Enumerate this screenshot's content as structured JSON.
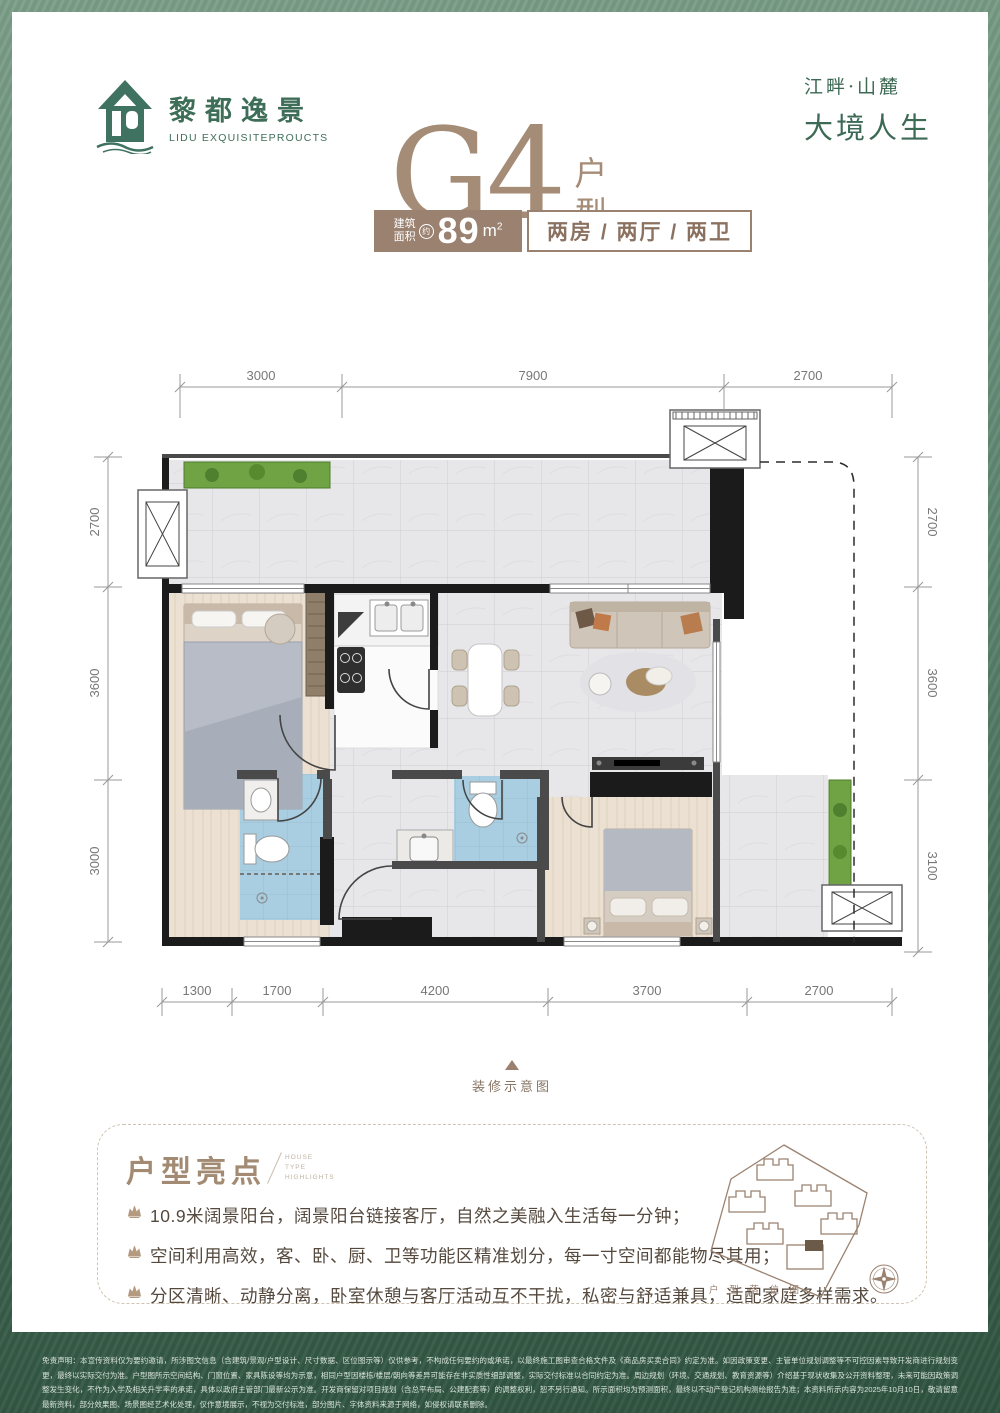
{
  "header": {
    "logo_cn": "黎都逸景",
    "logo_en": "LIDU EXQUISITEPROUCTS",
    "slogan_line1": "江畔·山麓",
    "slogan_line2": "大境人生"
  },
  "title": {
    "code": "G4",
    "suffix": "户型"
  },
  "banner": {
    "area_label_l1": "建筑",
    "area_label_l2": "面积",
    "approx": "约",
    "area_value": "89",
    "area_unit": "m",
    "area_sup": "2",
    "layout": "两房 / 两厅 / 两卫"
  },
  "plan": {
    "dims_top": [
      "3000",
      "7900",
      "2700"
    ],
    "dims_left": [
      "2700",
      "3600",
      "3000"
    ],
    "dims_right": [
      "2700",
      "3600",
      "3100"
    ],
    "dims_bottom": [
      "1300",
      "1700",
      "4200",
      "3700",
      "2700"
    ],
    "caption": "装修示意图"
  },
  "highlights": {
    "title": "户型亮点",
    "subtitle_l1": "HOUSE",
    "subtitle_l2": "TYPE",
    "subtitle_l3": "HIGHLIGHTS",
    "items": [
      "10.9米阔景阳台，阔景阳台链接客厅，自然之美融入生活每一分钟；",
      "空间利用高效，客、卧、厨、卫等功能区精准划分，每一寸空间都能物尽其用；",
      "分区清晰、动静分离，卧室休憩与客厅活动互不干扰，私密与舒适兼具，适配家庭多样需求。"
    ],
    "sitemap_label": "户 型 落 位 图"
  },
  "footer": {
    "disclaimer": "免责声明：本宣传资料仅为要约邀请，所涉图文信息（含建筑/景观/户型设计、尺寸数据、区位图示等）仅供参考，不构成任何要约的或承诺，以最终施工图审查合格文件及《商品房买卖合同》约定为准。如因政策变更、主管单位规划调整等不可控因素导致开发商进行规划变更，最终以实际交付为准。户型图所示空间结构、门窗位置、家具陈设等均为示意，相同户型因楼栋/楼层/朝向等差异可能存在非实质性细部调整，实际交付标准以合同约定为准。周边规划（环境、交通规划、教育资源等）介绍基于现状收集及公开资料整理，未来可能因政策调整发生变化，不作为入学及相关升学率的承诺，具体以政府主管部门最新公示为准。开发商保留对项目规划（含总平布局、公建配套等）的调整权利，恕不另行通知。所示面积均为预测面积，最终以不动产登记机构测绘报告为准；本资料所示内容为2025年10月10日，敬请留意最新资料，部分效果图、场景图经艺术化处理，仅作意境展示，不视为交付标准，部分图片、字体资料来源于网络，如侵权请联系删除。"
  }
}
